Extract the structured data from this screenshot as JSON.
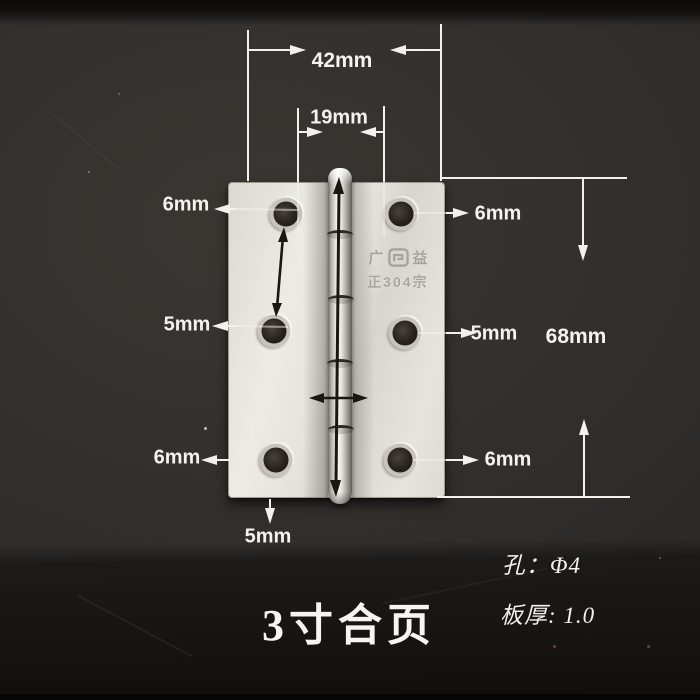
{
  "title": {
    "text": "3寸合页"
  },
  "specs": {
    "hole": "孔：Φ4",
    "thickness": "板厚: 1.0"
  },
  "stamp": {
    "prefix": "广",
    "suffix": "益",
    "cert": "正304宗",
    "logo_icon": "square-spiral-brand-mark"
  },
  "measurements": {
    "width_outer": "42mm",
    "width_inner": "19mm",
    "height": "68mm",
    "edge_top_left": "6mm",
    "edge_top_right": "6mm",
    "edge_mid_left": "5mm",
    "edge_mid_right": "5mm",
    "edge_bottom_left": "6mm",
    "edge_bottom_right": "6mm",
    "edge_bottom": "5mm"
  },
  "colors": {
    "background": "#322f2d",
    "background_bottom": "#141210",
    "plate_metal": "#e6e3dd",
    "dimension_lines": "#f2f1ee",
    "black_arrows": "#1a1713"
  }
}
